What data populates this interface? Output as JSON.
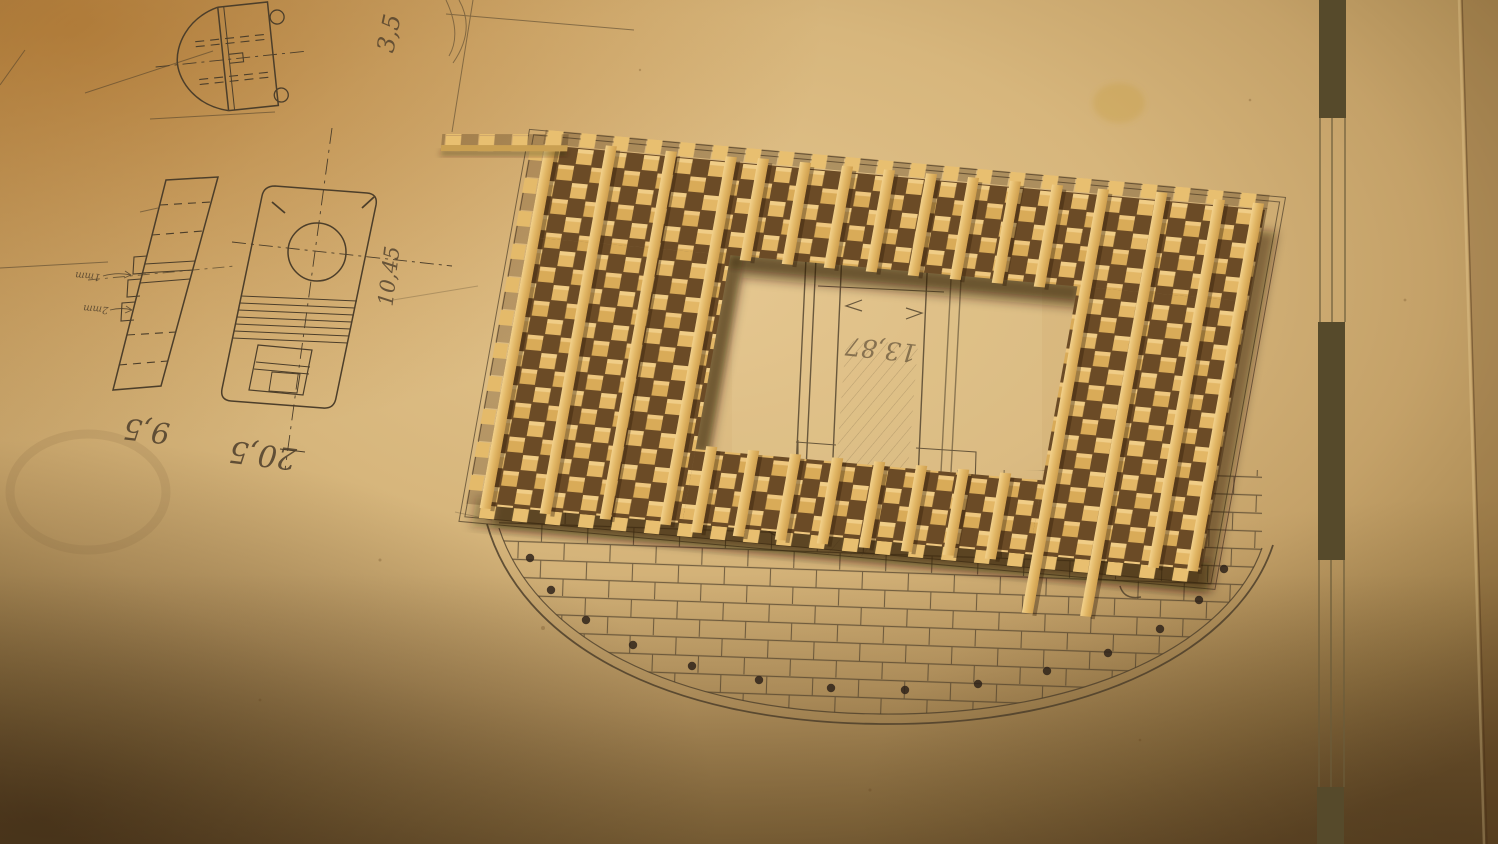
{
  "scene": {
    "annotations": {
      "top_dim": "3,5",
      "vertical_dim": "10,45",
      "left_part_dim": "9,5",
      "round_part_dim": "20,5",
      "opening_dim": "13,87",
      "offset_dim": "5mm",
      "step_dim_small": "1mm",
      "step_dim_large": "2mm"
    },
    "colors": {
      "paper_center": "#e3c48c",
      "paper_edge": "#86683c",
      "wood_light": "#e9c272",
      "wood_mid": "#d9ab58",
      "wood_gap": "#6b4b26",
      "pencil": "#4c3e2a",
      "scalebar_dark": "#564a2b"
    },
    "scale_bar": {
      "dark_segments": 3,
      "light_segments": 2
    }
  }
}
